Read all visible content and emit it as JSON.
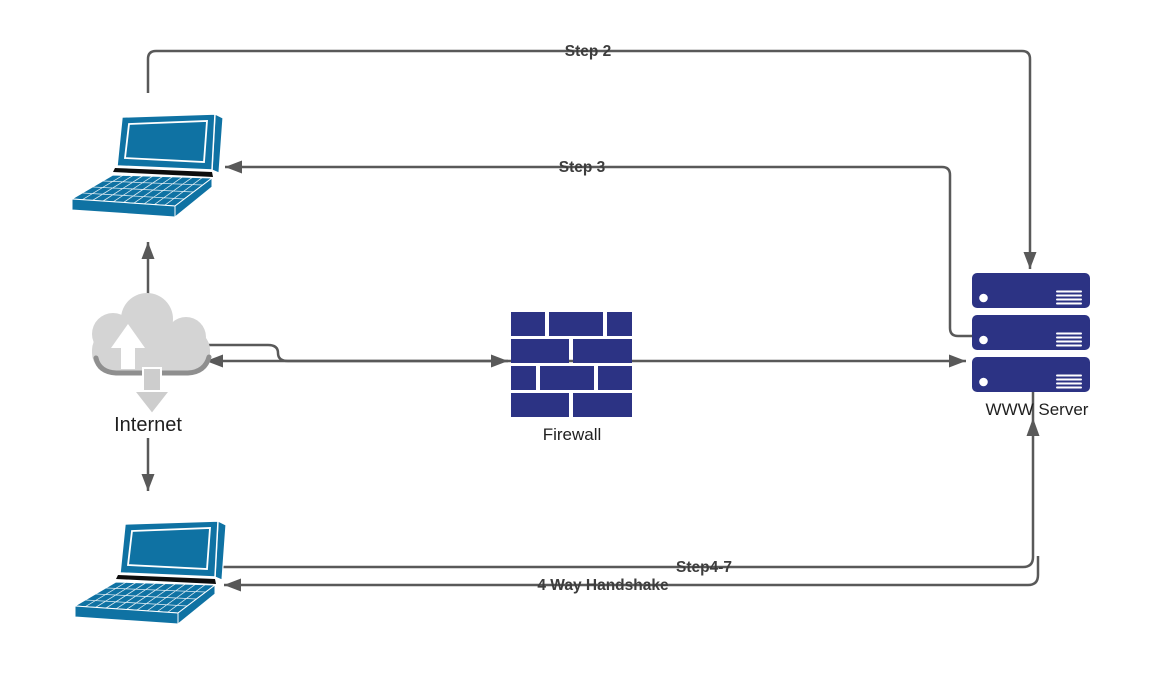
{
  "canvas": {
    "width": 1163,
    "height": 695,
    "background": "#ffffff"
  },
  "colors": {
    "line_gray": "#595959",
    "laptop_blue": "#0f72a3",
    "brick_navy": "#2c3384",
    "server_navy": "#2c3384",
    "cloud_gray": "#d4d4d4",
    "cloud_shadow": "#8f8f8f",
    "edge_label_gray": "#3d3d3d",
    "node_label_dark": "#1f1f1f"
  },
  "nodes": {
    "laptop_top": {
      "icon": "laptop-icon"
    },
    "laptop_bottom": {
      "icon": "laptop-icon"
    },
    "internet": {
      "label": "Internet",
      "icon": "cloud-icon"
    },
    "firewall": {
      "label": "Firewall",
      "icon": "firewall-brick-icon"
    },
    "www_server": {
      "label": "WWW Server",
      "icon": "server-stack-icon",
      "unit_count": 3
    }
  },
  "edges": {
    "step2": {
      "label": "Step 2",
      "from": "laptop_top",
      "to": "www_server",
      "arrow": "down-into-server-top"
    },
    "step3": {
      "label": "Step 3",
      "from": "www_server",
      "to": "laptop_top",
      "arrow": "left-into-laptop"
    },
    "step4_7": {
      "label": "Step4-7",
      "from": "laptop_bottom",
      "to": "www_server",
      "arrow": "up-into-server-bottom"
    },
    "handshake": {
      "label": "4 Way Handshake",
      "from": "www_server",
      "to": "laptop_bottom",
      "arrow": "left-into-laptop"
    },
    "internet_to_laptop_top": {
      "label": "",
      "from": "internet",
      "to": "laptop_top",
      "arrow": "up"
    },
    "internet_to_laptop_bottom": {
      "label": "",
      "from": "internet",
      "to": "laptop_bottom",
      "arrow": "down"
    },
    "internet_to_firewall": {
      "label": "",
      "from": "internet",
      "to": "firewall",
      "arrow": "right-into-firewall"
    },
    "to_internet": {
      "label": "",
      "from": "firewall",
      "to": "internet",
      "arrow": "left-into-cloud"
    },
    "firewall_to_server": {
      "label": "",
      "from": "firewall",
      "to": "www_server",
      "arrow": "right-into-server"
    }
  }
}
